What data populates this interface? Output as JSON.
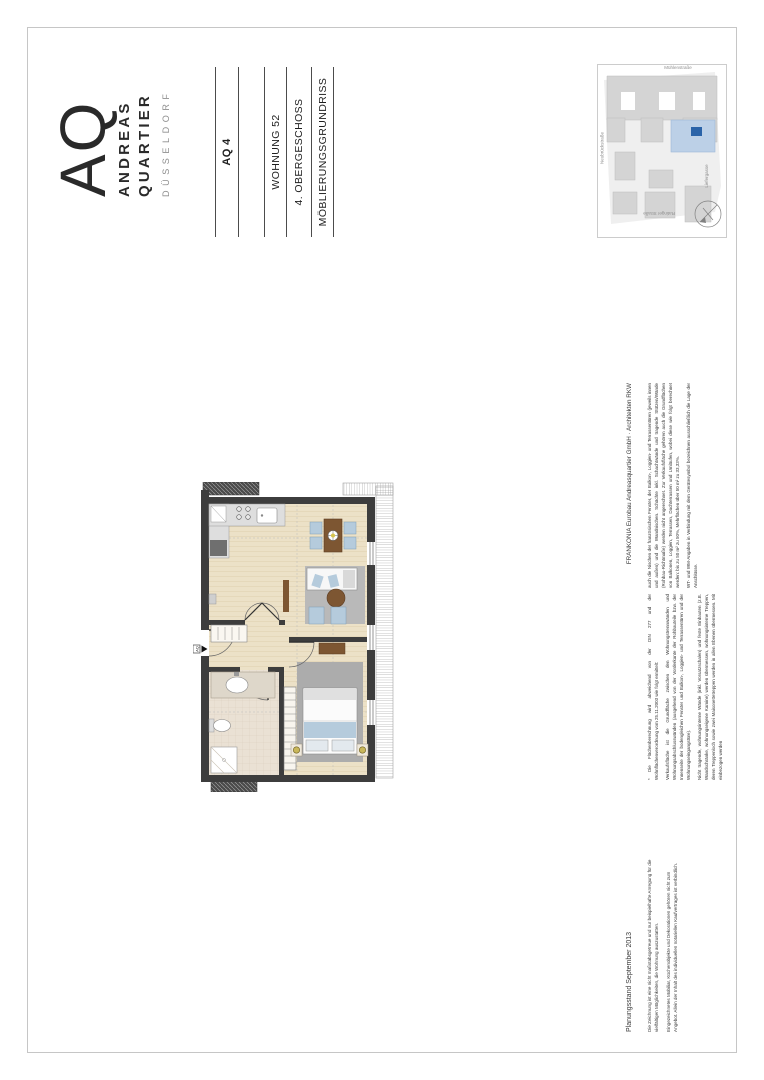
{
  "logo": {
    "monogram": "AQ",
    "word1": "ANDREAS",
    "word2": "QUARTIER",
    "city": "DÜSSELDORF"
  },
  "title_block": {
    "project": "AQ 4",
    "unit": "WOHNUNG 52",
    "floor": "4. OBERGESCHOSS",
    "drawing_type": "MÖBLIERUNGSGRUNDRISS"
  },
  "site_map": {
    "street_top": "Neubrückstraße",
    "street_right": "Mühlenstraße",
    "street_bottom": "Liefergasse",
    "street_left": "Ratinger Straße",
    "highlight_color": "#bcd0e7",
    "marker_color": "#2a63a8"
  },
  "floor_plan": {
    "entrance_label": "AQ"
  },
  "footer": {
    "planning_status": "Planungsstand September 2013",
    "credit": "FRANKONIA Eurobau Andreasquartier GmbH · Architekten RKW",
    "disclaimer_1": "Die Zeichnung ist eine nicht maßstabsgetreue und nur beispielhafte Anregung für die vielfältigen Möglichkeiten, die Wohnung auszustatten.",
    "disclaimer_2": "Eingezeichnetes Mobiliar, Küchenobjekte und Dekorationen gehören nicht zum Angebot. Allein der Inhalt des individuellen notariellen Kaufvertrages ist verbindlich.",
    "legal_col1_p1": "* Die Flächenberechnung wird abweichend von der DIN 277 und der Wohnflächenverordnung vom 25.11.2003 wie folgt ermittelt:",
    "legal_col1_p2": "Verkaufsfläche ist die Grundfläche zwischen den Wohnungstrennwänden und Wohnungsabschlusswänden (ausgehend von der Vorderkante der Rohbauteile bzw. der Innenseite der bodengleichen Fenster und Balkon-, Loggien- und Terrassentüren und der Wohnungseingangstüre).",
    "legal_col1_p3": "Nicht tragende, wohnungsinterne Wände (inkl. Vorsatzschalen) und feste Einbauten (z.B. Wandschränke, wohnungseigene Kamine) werden übermessen, wohnungsinterne Treppen, deren Treppenloch sowie zwei Maisonettetreppen werden in allen Ebenen übermessen. Mit einbezogen werden",
    "legal_col2_p1": "auch die Nischen der französischen Fenster, der Balkon-, Loggien- und Terrassentüren (jeweils innen und außen) und die Wandnischen. Schächte inkl. Schachtwände und tragende Stützen/Wände (Rohbau-Richtmaße) werden nicht angerechnet. Zur Verkaufsfläche gehören auch die Grundflächen von Balkonen, Loggien, Terrassen, Dachterrassen und Umläufen, wobei diese wie folgt berechnet werden: bis zu 50 m² zu 50%, Mehrflächen über 50 m² zu 33,33%.",
    "legal_col2_p2": "WT- und WM-Angaben in Verbindung mit dem Gerätesymbol bezeichnen ausschließlich die Lage der Anschlüsse."
  }
}
